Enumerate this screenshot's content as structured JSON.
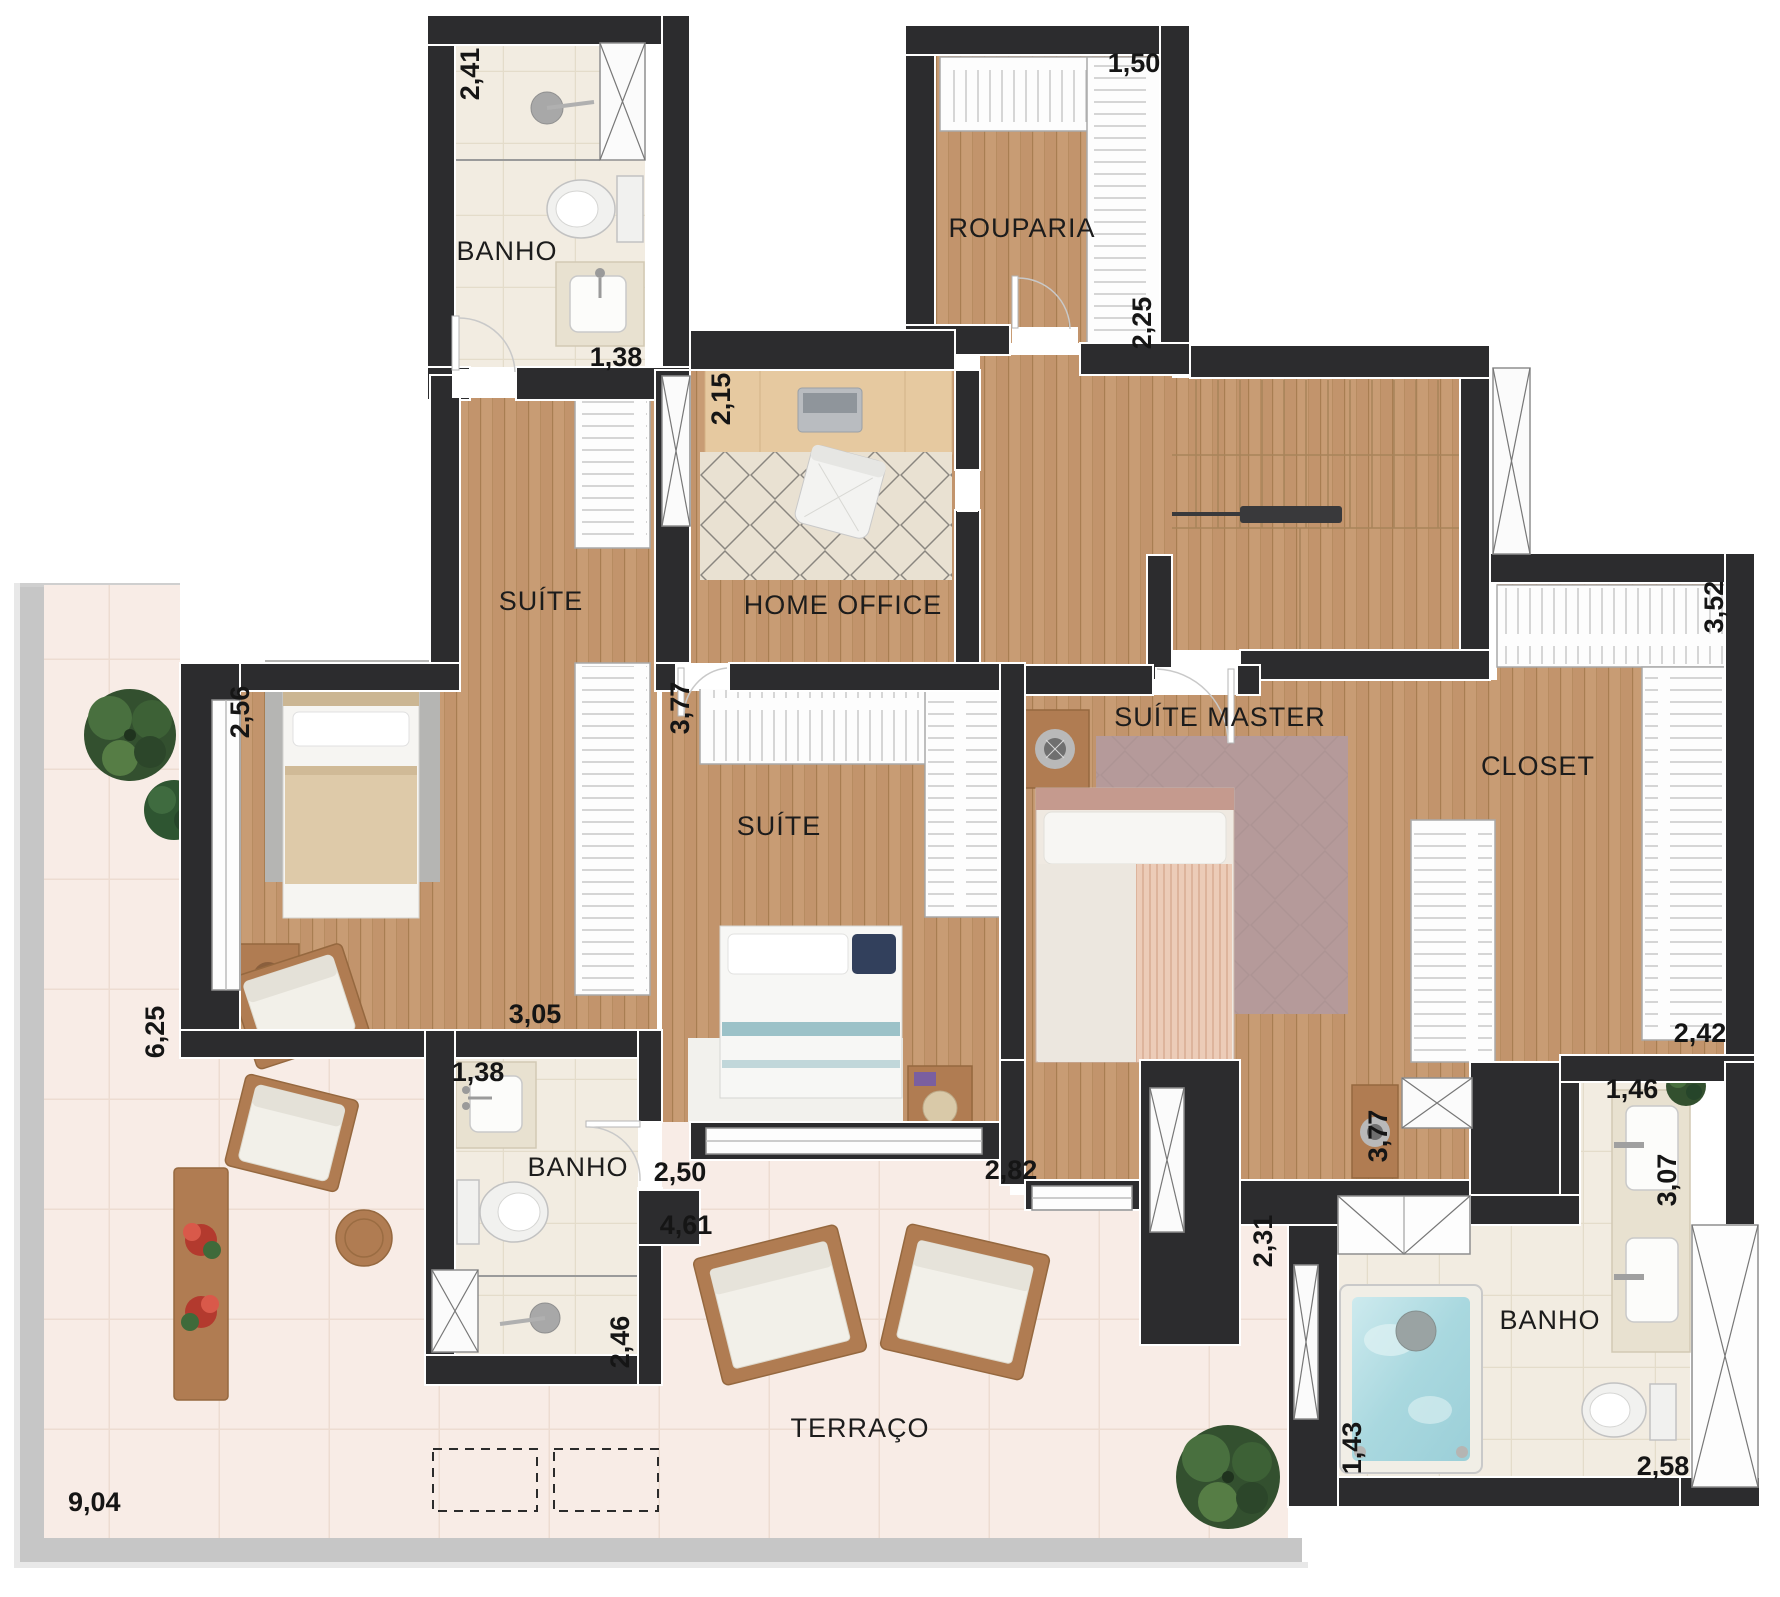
{
  "rooms": {
    "banho_top": "BANHO",
    "rouparia": "ROUPARIA",
    "suite_1": "SUÍTE",
    "home_office": "HOME OFFICE",
    "suite_2": "SUÍTE",
    "suite_master": "SUÍTE MASTER",
    "closet": "CLOSET",
    "banho_middle": "BANHO",
    "banho_master": "BANHO",
    "terrace": "TERRAÇO"
  },
  "dimensions_m": {
    "banho_top_depth": "2,41",
    "banho_top_width": "1,38",
    "rouparia_width": "1,50",
    "rouparia_depth": "2,25",
    "home_office_side": "2,15",
    "suite_1_window": "2,56",
    "suite_1_wall": "3,05",
    "suite_2_depth": "3,77",
    "suite_2_width": "2,50",
    "suite_master_width": "2,82",
    "suite_master_depth": "3,77",
    "closet_top": "3,52",
    "closet_side": "2,42",
    "banho_middle_sink": "1,38",
    "banho_middle_depth": "2,46",
    "banho_master_top": "1,46",
    "banho_master_side": "3,07",
    "banho_master_bottom": "2,58",
    "bathtub": "1,43",
    "terrace_left": "6,25",
    "terrace_mid": "4,61",
    "terrace_door": "2,31",
    "terrace_bottom": "9,04"
  },
  "colors": {
    "wall": "#2c2c2e",
    "wood_floor": "#c89c74",
    "terrace_tile": "#f8ece6",
    "bath_tile": "#f2ece1",
    "water": "#a9d8df",
    "wood_furniture": "#b07c52",
    "greenery": "#33502f",
    "master_rug": "#b59a9a"
  }
}
